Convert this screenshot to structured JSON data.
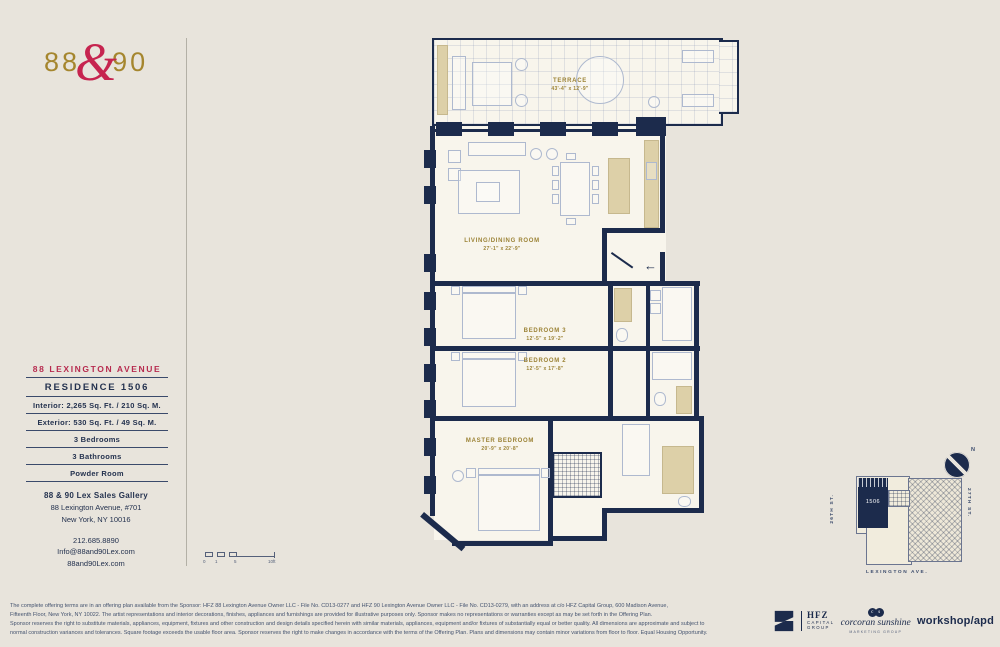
{
  "brand": {
    "left": "88",
    "ampersand": "&",
    "right": "90"
  },
  "info_panel": {
    "building": "88 LEXINGTON AVENUE",
    "residence": "RESIDENCE 1506",
    "specs": [
      "Interior: 2,265 Sq. Ft. / 210 Sq. M.",
      "Exterior: 530 Sq. Ft. / 49 Sq. M.",
      "3 Bedrooms",
      "3 Bathrooms",
      "Powder Room"
    ]
  },
  "contact": {
    "gallery_name": "88 & 90 Lex Sales Gallery",
    "address_line1": "88 Lexington Avenue, #701",
    "address_line2": "New York, NY 10016",
    "phone": "212.685.8890",
    "email": "Info@88and90Lex.com",
    "website": "88and90Lex.com"
  },
  "floor_plan": {
    "terrace": {
      "name": "TERRACE",
      "dims": "43'-4\" x 12'-9\""
    },
    "living": {
      "name": "LIVING/DINING ROOM",
      "dims": "27'-1\" x 22'-9\""
    },
    "bedroom3": {
      "name": "BEDROOM 3",
      "dims": "12'-5\" x 19'-2\""
    },
    "bedroom2": {
      "name": "BEDROOM 2",
      "dims": "12'-5\" x 17'-8\""
    },
    "master": {
      "name": "MASTER BEDROOM",
      "dims": "20'-9\" x 20'-8\""
    },
    "entry_arrow": "←",
    "scale": {
      "start": "0",
      "one": "1",
      "mid": "5",
      "end": "10ft"
    }
  },
  "key_plan": {
    "unit": "1506",
    "street_left": "26TH ST.",
    "street_right": "27TH ST.",
    "avenue": "LEXINGTON AVE.",
    "north": "N"
  },
  "disclaimer": {
    "line1": "The complete offering terms are in an offering plan available from the Sponsor: HFZ 88 Lexington Avenue Owner LLC - File No. CD13-0277 and HFZ 90 Lexington Avenue Owner LLC - File No. CD13-0279, with an address at c/o HFZ Capital Group, 600 Madison Avenue,",
    "line2": "Fifteenth Floor, New York, NY 10022. The artist representations and interior decorations, finishes, appliances and furnishings are provided for illustrative purposes only. Sponsor makes no representations or warranties except as may be set forth in the Offering Plan.",
    "line3": "Sponsor reserves the right to substitute materials, appliances, equipment, fixtures and other construction and design details specified herein with similar materials, appliances, equipment and/or fixtures of substantially equal or better quality. All dimensions are approximate and subject to",
    "line4": "normal construction variances and tolerances. Square footage exceeds the usable floor area. Sponsor reserves the right to make changes in accordance with the terms of the Offering Plan. Plans and dimensions may contain minor variations from floor to floor. Equal Housing Opportunity."
  },
  "partner_logos": {
    "hfz": {
      "name": "HFZ",
      "line1": "CAPITAL",
      "line2": "GROUP"
    },
    "corcoran": {
      "c": "c",
      "s": "s",
      "name": "corcoran sunshine",
      "tagline": "MARKETING GROUP"
    },
    "workshop": "workshop/apd"
  },
  "colors": {
    "navy": "#1c2b4c",
    "gold": "#9c8336",
    "crimson": "#c6244f",
    "background": "#e8e4dc",
    "paper": "#f8f5ec",
    "tan": "#ddd0a8"
  }
}
